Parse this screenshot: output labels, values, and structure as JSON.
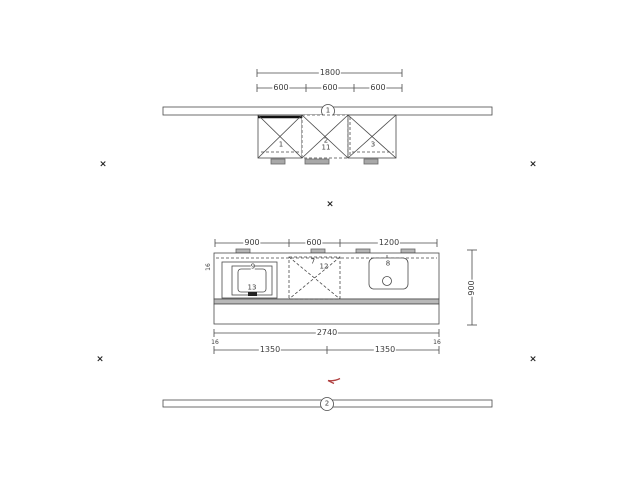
{
  "elevation_view": {
    "dim_total": "1800",
    "dim_segments": [
      "600",
      "600",
      "600"
    ],
    "section_marker": "1",
    "cabinet_labels": {
      "left": "1",
      "mid": "2",
      "mid_sub": "11",
      "right": "3"
    }
  },
  "plan_view": {
    "dim_segments": [
      "900",
      "600",
      "1200"
    ],
    "dim_depth": "900",
    "dim_total": "2740",
    "dim_bottom_left_panel": "16",
    "dim_bottom_left": "1350",
    "dim_bottom_right": "1350",
    "dim_bottom_right_panel": "16",
    "edge_panel_label": "16",
    "item_labels": {
      "hob_frame": "9",
      "hob_detail": "13",
      "mid_cabinet": "7",
      "mid_cabinet_alt": "12",
      "sink": "8"
    }
  },
  "bottom_rail": {
    "section_marker": "2"
  },
  "cross_mark": "×",
  "colors": {
    "line": "#4a4a4a",
    "annotation": "#b04040"
  }
}
